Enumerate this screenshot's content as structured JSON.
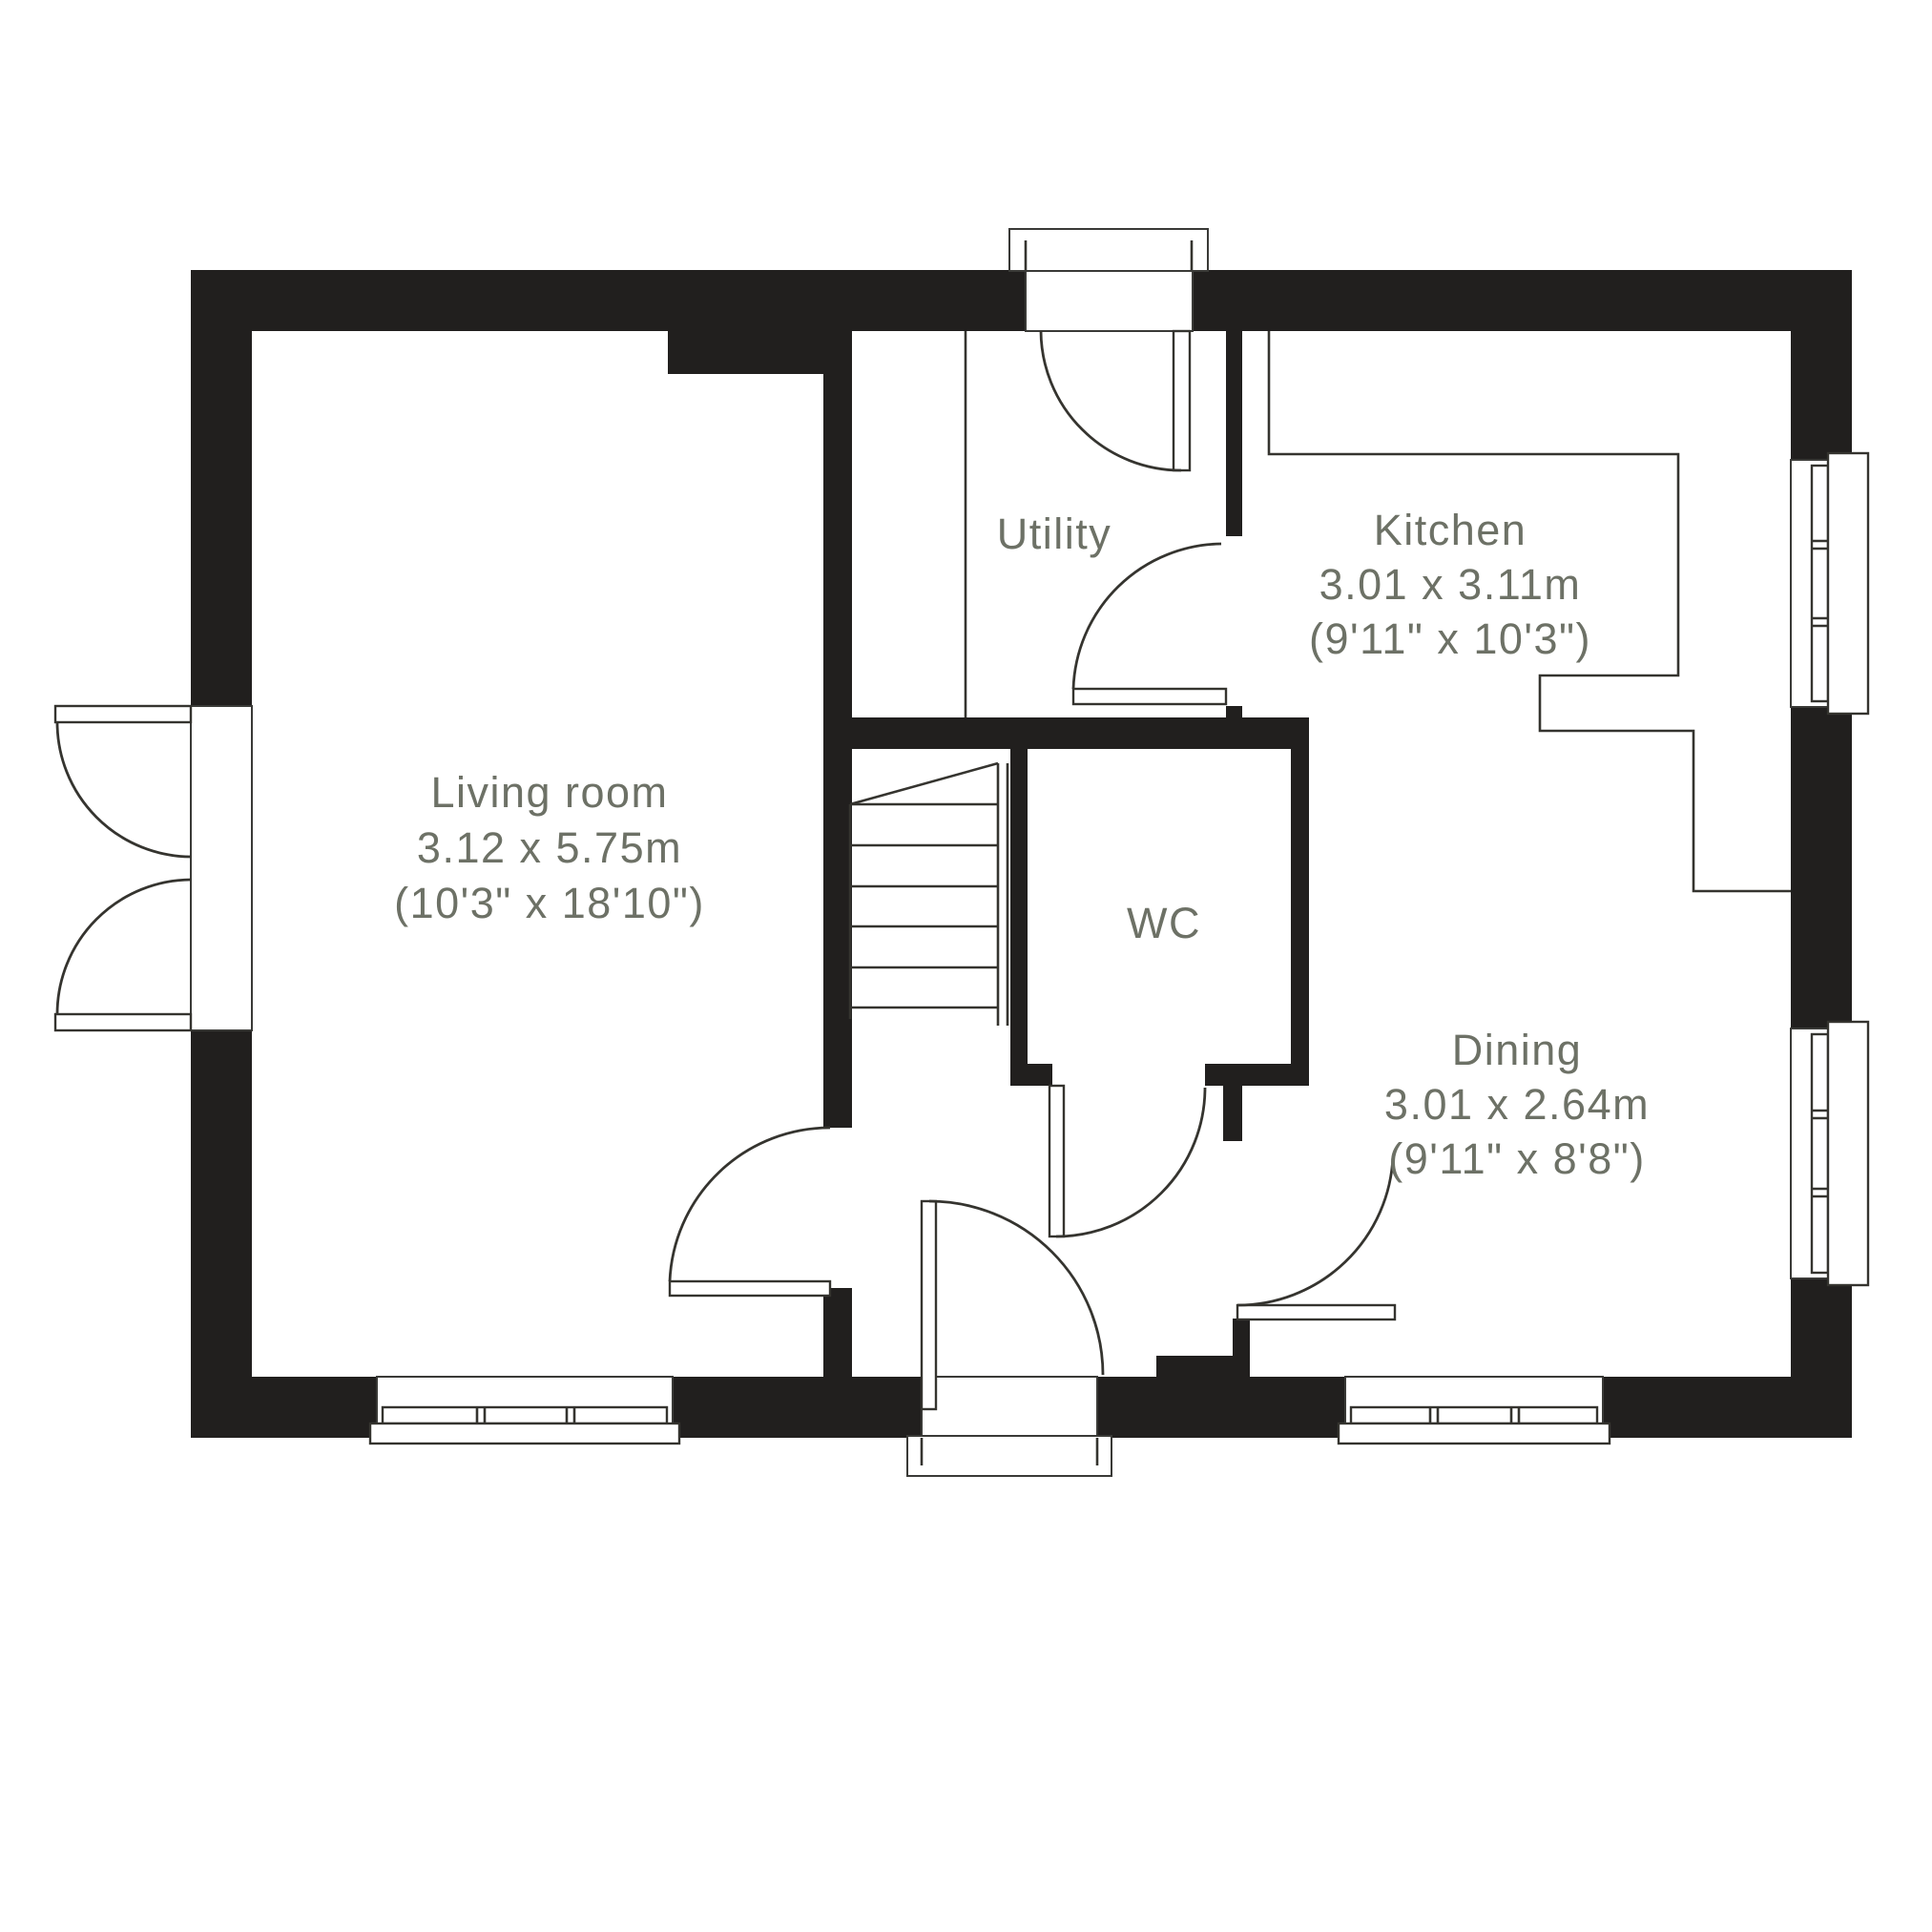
{
  "plan": {
    "title": "Ground floor plan",
    "rooms": [
      {
        "id": "living-room",
        "name": "Living room",
        "metric": "3.12 x 5.75m",
        "imperial": "(10'3\" x 18'10\")"
      },
      {
        "id": "utility",
        "name": "Utility",
        "metric": "",
        "imperial": ""
      },
      {
        "id": "kitchen",
        "name": "Kitchen",
        "metric": "3.01 x 3.11m",
        "imperial": "(9'11\" x 10'3\")"
      },
      {
        "id": "wc",
        "name": "WC",
        "metric": "",
        "imperial": ""
      },
      {
        "id": "dining",
        "name": "Dining",
        "metric": "3.01 x 2.64m",
        "imperial": "(9'11\" x 8'8\")"
      }
    ],
    "features": {
      "windows": 4,
      "external_doors": 3,
      "stairs": 1
    },
    "colors": {
      "wall": "#211f1e",
      "line": "#35342f",
      "label": "#6d7166",
      "background": "#ffffff"
    }
  }
}
